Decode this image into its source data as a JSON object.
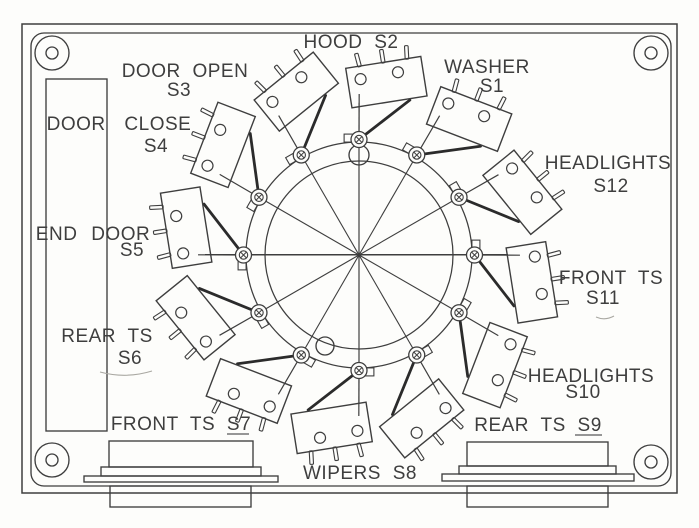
{
  "drawing": {
    "kind": "switch-panel-layout",
    "ink_color": "#3e3e3e",
    "heavy_ink_color": "#2b2b2b",
    "background_color": "#fdfdfb",
    "switches": [
      {
        "designator": "S1",
        "function": "WASHER",
        "position_deg": 60,
        "label_lines": [
          "WASHER",
          "S1"
        ]
      },
      {
        "designator": "S2",
        "function": "HOOD",
        "position_deg": 90,
        "label_lines": [
          "HOOD S2"
        ]
      },
      {
        "designator": "S3",
        "function": "DOOR OPEN",
        "position_deg": 120,
        "label_lines": [
          "DOOR OPEN",
          "S3"
        ]
      },
      {
        "designator": "S4",
        "function": "DOOR CLOSE",
        "position_deg": 150,
        "label_lines": [
          "DOOR CLOSE",
          "S4"
        ]
      },
      {
        "designator": "S5",
        "function": "END DOOR",
        "position_deg": 180,
        "label_lines": [
          "END DOOR",
          "S5"
        ]
      },
      {
        "designator": "S6",
        "function": "REAR TS",
        "position_deg": 210,
        "label_lines": [
          "REAR TS",
          "S6"
        ]
      },
      {
        "designator": "S7",
        "function": "FRONT TS",
        "position_deg": 240,
        "label_lines": [
          "FRONT TS S7"
        ]
      },
      {
        "designator": "S8",
        "function": "WIPERS",
        "position_deg": 270,
        "label_lines": [
          "WIPERS S8"
        ]
      },
      {
        "designator": "S9",
        "function": "REAR TS",
        "position_deg": 300,
        "label_lines": [
          "REAR TS S9"
        ]
      },
      {
        "designator": "S10",
        "function": "HEADLIGHTS",
        "position_deg": 330,
        "label_lines": [
          "HEADLIGHTS",
          "S10"
        ]
      },
      {
        "designator": "S11",
        "function": "FRONT TS",
        "position_deg": 0,
        "label_lines": [
          "FRONT TS",
          "S11"
        ]
      },
      {
        "designator": "S12",
        "function": "HEADLIGHTS",
        "position_deg": 30,
        "label_lines": [
          "HEADLIGHTS",
          "S12"
        ]
      }
    ]
  }
}
